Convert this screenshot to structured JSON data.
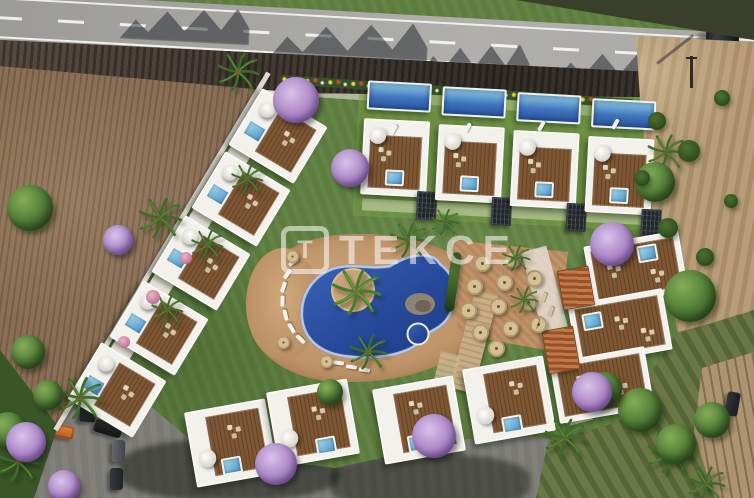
{
  "scene": {
    "type": "aerial-architectural-render",
    "description": "Bird's-eye 3D render of a gated villa resort: four detached pool villas along the top, a diagonal row of roof-terrace villas on the left, a terraced apartment block on the right, a row of villas at the bottom, a freeform lagoon pool with a palm island and round jacuzzi in the centre, a straw-umbrella lounge court, a car park with vehicles, a highway along the top edge, a ploughed field on the left and bare dirt fields on the right."
  },
  "watermark": {
    "logo_letter": "T",
    "text": "TEKCE"
  },
  "counts": {
    "top_row_pool_villas": 4,
    "left_row_villas": 5,
    "bottom_row_villas": 4,
    "right_block_terrace_units": 3,
    "straw_umbrellas": 12,
    "parked_cars": 5,
    "cars_on_road": 1,
    "cars_on_dirt_track": 1
  },
  "palette": {
    "road_asphalt": "#a5a4a1",
    "embankment_shadow": "#3a332d",
    "ploughed_field": "#8a6f55",
    "lawn_green": "#5c7d3d",
    "dark_foliage": "#2e5220",
    "lagoon_pool_water": "#2a55a0",
    "plunge_pool_water": "#6fb5d8",
    "wood_deck": "#7d5633",
    "white_structure": "#f2f1ec",
    "pool_deck_stone": "#bb9065",
    "terracotta_roof": "#a55c32",
    "straw_umbrella": "#d5bf95",
    "jacaranda_purple": "#a983c4",
    "dirt_field": "#b79d79",
    "rough_field_green": "#6b7845",
    "asphalt_drive": "#7b7a74",
    "orange_car": "#c96a2e"
  }
}
